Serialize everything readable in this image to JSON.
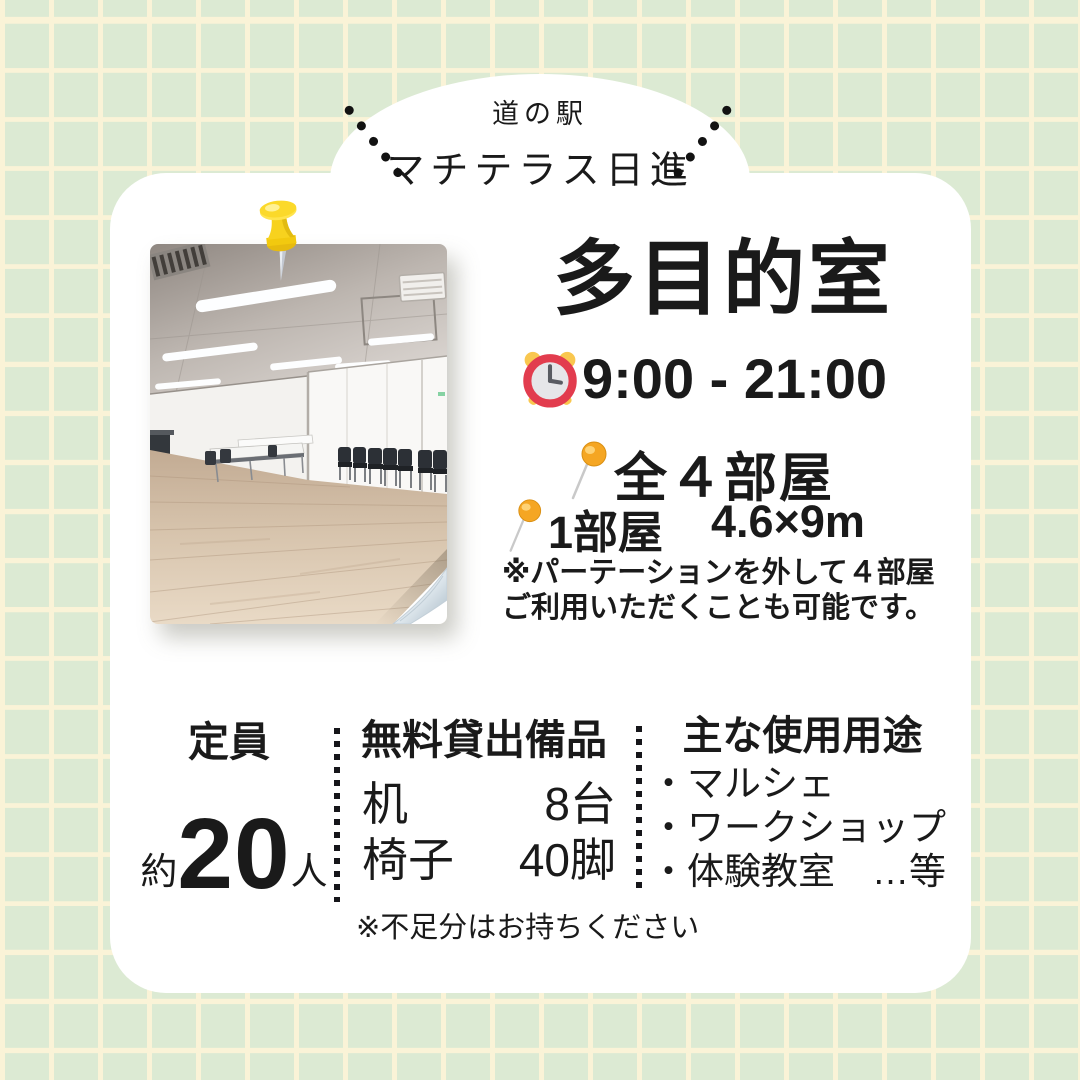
{
  "header": {
    "station_label": "道の駅",
    "station_name": "マチテラス日進"
  },
  "room": {
    "title": "多目的室",
    "hours": "9:00 - 21:00",
    "total_rooms": "全４部屋",
    "unit_label": "1部屋",
    "unit_size": "4.6×9m",
    "partition_note_line1": "※パーテーションを外して４部屋",
    "partition_note_line2": "ご利用いただくことも可能です。"
  },
  "capacity": {
    "header": "定員",
    "approx": "約",
    "value": "20",
    "unit": "人"
  },
  "equipment": {
    "header": "無料貸出備品",
    "items": [
      {
        "name": "机",
        "qty": "8台"
      },
      {
        "name": "椅子",
        "qty": "40脚"
      }
    ],
    "note": "※不足分はお持ちください"
  },
  "usage": {
    "header": "主な使用用途",
    "items": [
      "・マルシェ",
      "・ワークショップ",
      "・体験教室　…等"
    ]
  },
  "icons": {
    "clock": "alarm-clock-icon",
    "pin": "pin-icon",
    "pushpin": "pushpin-icon"
  },
  "colors": {
    "background_green": "#dcead3",
    "grid_line_cream": "#faf3d7",
    "card_white": "#ffffff",
    "text_black": "#1a1a1a",
    "clock_red": "#e23c4e",
    "bell_yellow": "#f9c74f",
    "pin_yellow": "#f5a623",
    "pushpin_yellow": "#f7d21e"
  }
}
